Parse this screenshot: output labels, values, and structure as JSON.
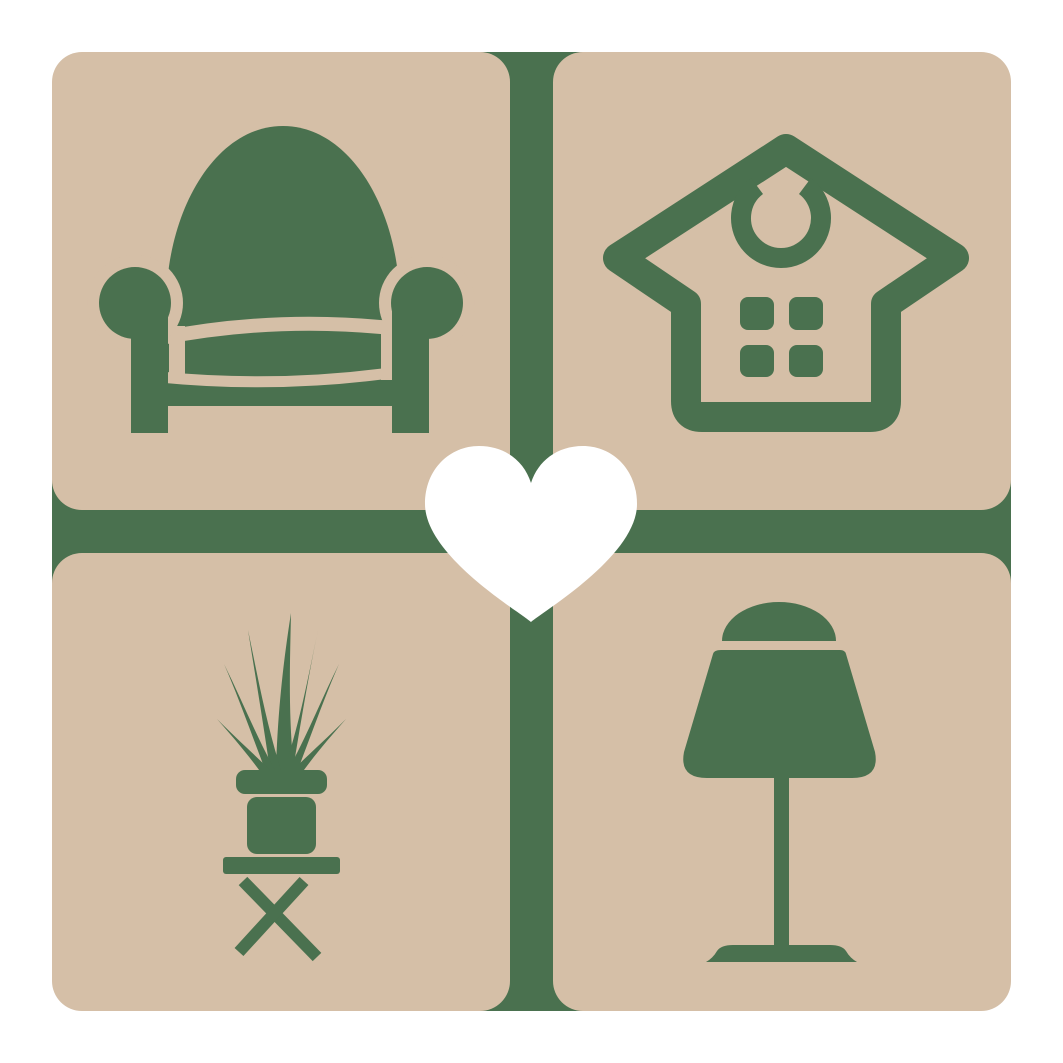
{
  "logo": {
    "kind": "logo-graphic",
    "subject": "home and furniture favorites emblem",
    "colors": {
      "background": "#ffffff",
      "tile": "#d5bfa7",
      "icon": "#4a714f",
      "heart": "#ffffff"
    },
    "tiles": [
      {
        "position": "top-left",
        "icon": "armchair-icon"
      },
      {
        "position": "top-right",
        "icon": "house-icon"
      },
      {
        "position": "bottom-left",
        "icon": "potted-plant-icon"
      },
      {
        "position": "bottom-right",
        "icon": "table-lamp-icon"
      }
    ],
    "divider": {
      "shape": "cross"
    },
    "center": {
      "icon": "heart-icon"
    }
  }
}
